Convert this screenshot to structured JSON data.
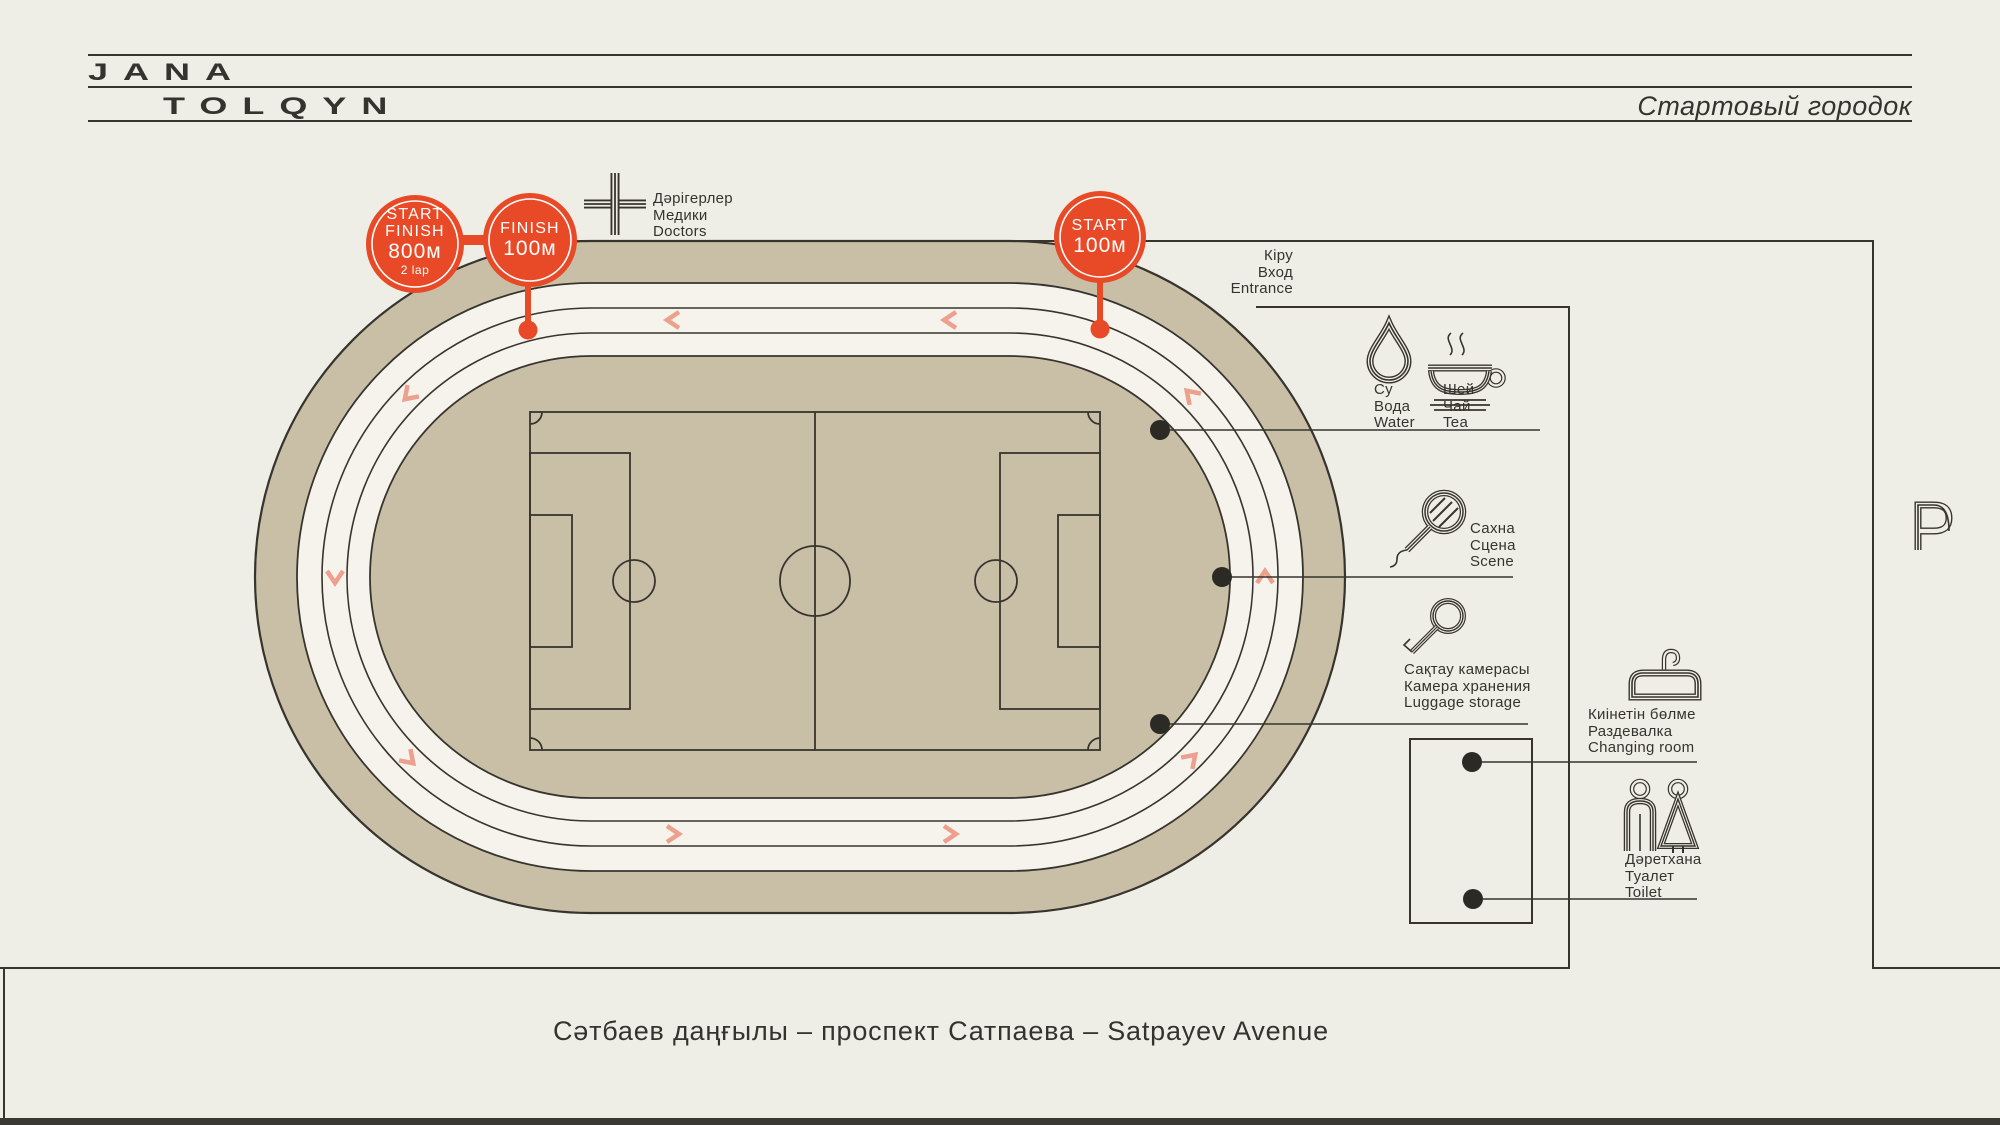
{
  "header": {
    "brand_line1": "JANA",
    "brand_line2": "TOLQYN",
    "title": "Стартовый городок"
  },
  "badges": {
    "start_finish_800": {
      "line1": "START",
      "line2": "FINISH",
      "line3": "800м",
      "line4": "2 lap"
    },
    "finish_100": {
      "line1": "FINISH",
      "line2": "100м"
    },
    "start_100": {
      "line1": "START",
      "line2": "100м"
    }
  },
  "legend": {
    "doctors": {
      "icon": "medical-cross",
      "lines": [
        "Дәрігерлер",
        "Медики",
        "Doctors"
      ]
    },
    "entrance": {
      "icon": "none",
      "lines": [
        "Кіру",
        "Вход",
        "Entrance"
      ]
    },
    "water": {
      "icon": "water-drop",
      "lines": [
        "Су",
        "Вода",
        "Water"
      ]
    },
    "tea": {
      "icon": "tea-cup",
      "lines": [
        "Шей",
        "Чай",
        "Tea"
      ]
    },
    "scene": {
      "icon": "microphone",
      "lines": [
        "Сахна",
        "Сцена",
        "Scene"
      ]
    },
    "luggage": {
      "icon": "key",
      "lines": [
        "Сақтау камерасы",
        "Камера хранения",
        "Luggage storage"
      ]
    },
    "changing": {
      "icon": "hanger",
      "lines": [
        "Киінетін бөлме",
        "Раздевалка",
        "Changing room"
      ]
    },
    "toilet": {
      "icon": "man-woman",
      "lines": [
        "Дәретхана",
        "Туалет",
        "Toilet"
      ]
    },
    "parking": {
      "icon": "parking-p",
      "symbol": "P"
    }
  },
  "street": {
    "label": "Сәтбаев даңғылы – проспект Сатпаева – Satpayev Avenue"
  },
  "colors": {
    "background": "#efeee6",
    "track_tan": "#c9bfa7",
    "lane_white": "#f5f3eb",
    "line_dark": "#37342e",
    "accent_red": "#e84a27",
    "arrow_salmon": "#eda08e",
    "footer_bar": "#3b3934",
    "badge_text": "#ffffff"
  }
}
